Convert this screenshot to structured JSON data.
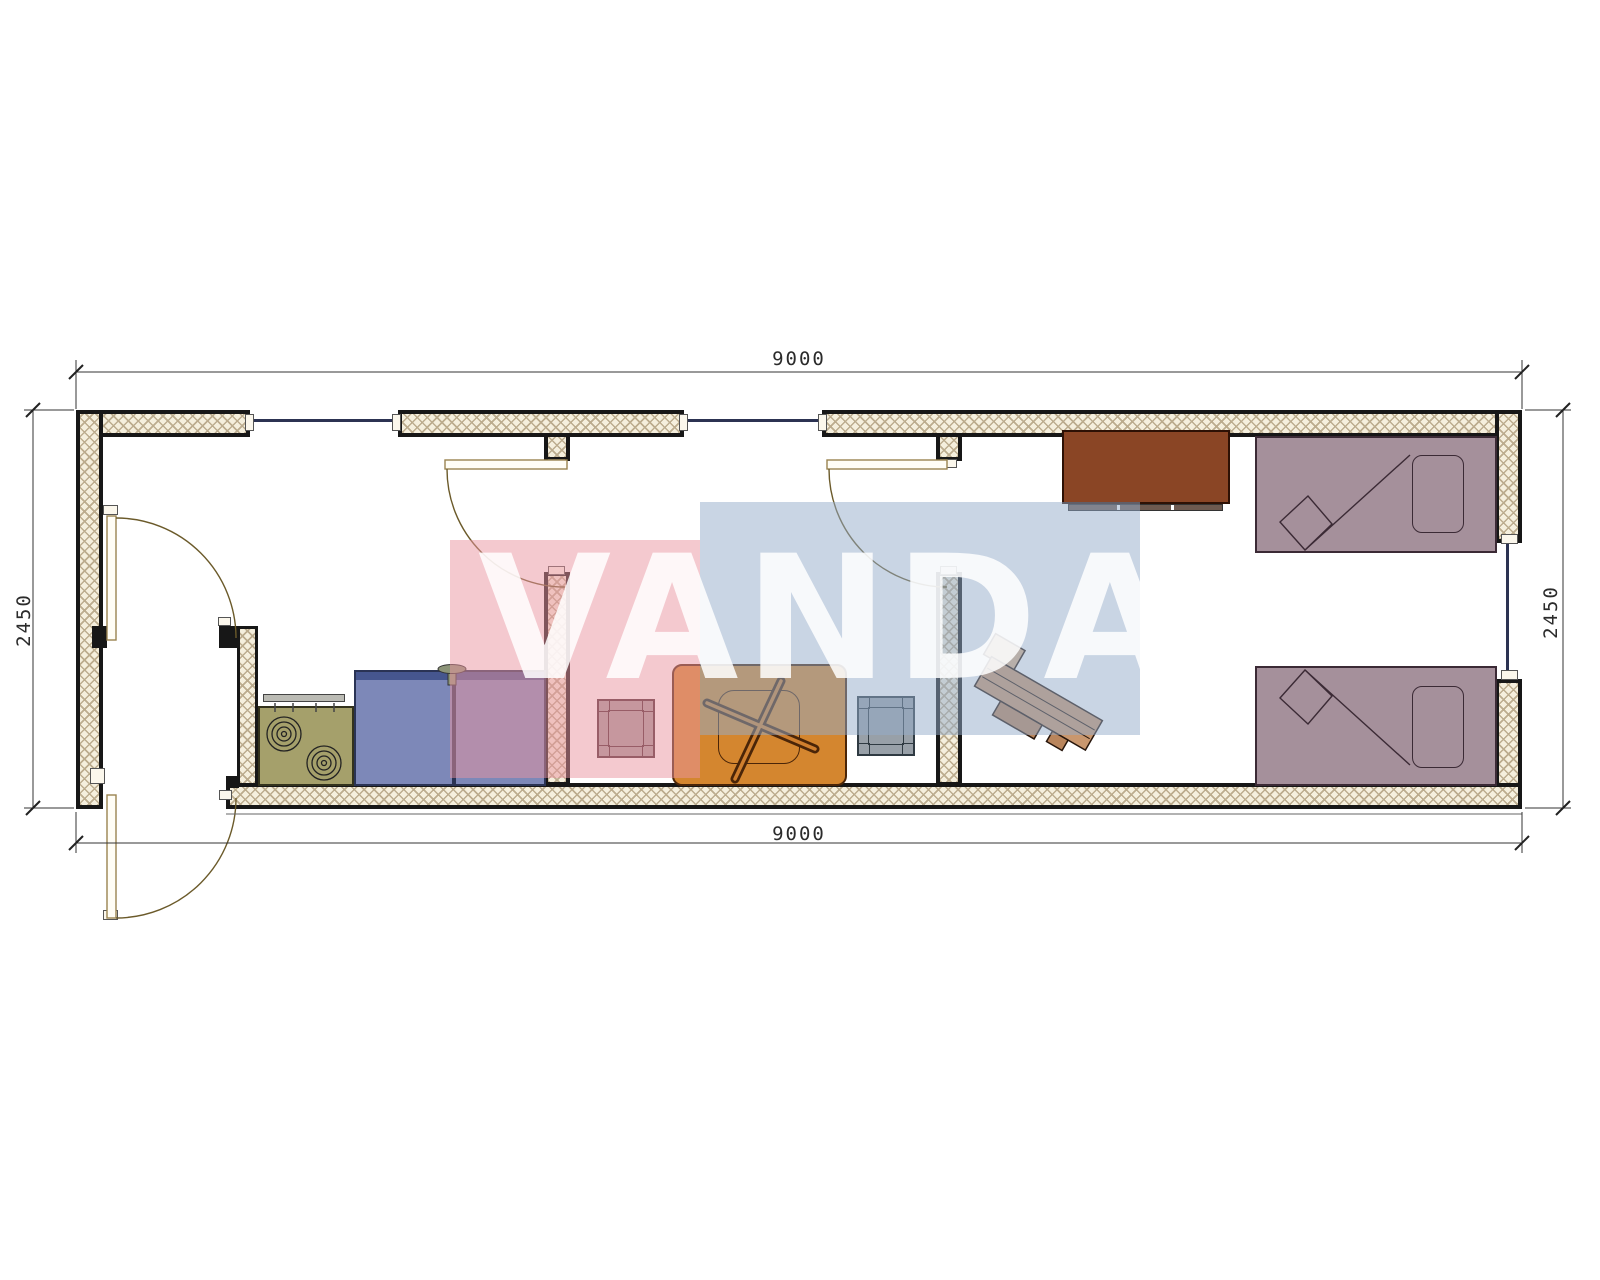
{
  "drawing": {
    "type": "floor-plan",
    "description": "Single-row modular container house plan 9000 x 2450 with kitchen/entry, middle room and bedroom",
    "rooms": [
      {
        "name": "entry-kitchen",
        "furniture": [
          "two-burner-stove",
          "wall-shelf",
          "kitchen-cabinet",
          "sink-cabinet-with-faucet"
        ]
      },
      {
        "name": "middle-room",
        "furniture": [
          "stool",
          "table-with-x-base",
          "stool"
        ]
      },
      {
        "name": "bedroom",
        "furniture": [
          "wardrobe",
          "single-bed-with-pillow",
          "desk",
          "single-bed-with-pillow"
        ]
      }
    ],
    "openings": {
      "exterior_doors": 1,
      "interior_doors": 3,
      "windows": 3
    }
  },
  "dimensions": {
    "top": "9000",
    "bottom": "9000",
    "left": "2450",
    "right": "2450"
  },
  "watermark": {
    "text": "VANDA",
    "pink_color": "#e994a0",
    "blue_color": "#94acca"
  },
  "colors": {
    "wall_hatch_bg": "#f5efdd",
    "wall_outline": "#171717",
    "stove": "#a5a06b",
    "cabinet": "#7d88b8",
    "cabinet_band": "#46568e",
    "table": "#d4862f",
    "stool_left": "#a39a9c",
    "stool_right": "#98a0a8",
    "wardrobe": "#8a4525",
    "bed": "#a5909b",
    "desk": "#c9976e",
    "window_glass": "#2c3352",
    "door_line": "#9a8350"
  }
}
